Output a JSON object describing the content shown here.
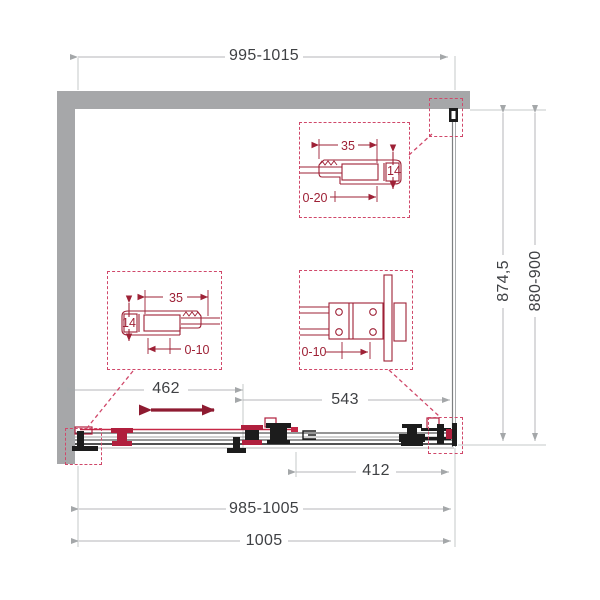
{
  "dimensions": {
    "top_width": "995-1015",
    "side_height_fixed": "874,5",
    "side_height_range": "880-900",
    "door_travel": "462",
    "fixed_panel": "543",
    "opening": "412",
    "bottom_width_range": "985-1005",
    "bottom_width_total": "1005"
  },
  "details": {
    "wall_profile_top": {
      "width": "35",
      "depth": "14",
      "adjustment": "0-20"
    },
    "wall_profile_left": {
      "width": "35",
      "depth": "14",
      "adjustment": "0-10"
    },
    "roller_carriage": {
      "adjustment": "0-10"
    }
  },
  "colors": {
    "wall": "#a6a7a9",
    "dimension_line": "#b4b6b8",
    "dimension_text": "#3f4144",
    "detail_red": "#9e2136",
    "bright_red": "#c62846",
    "dashed_box": "#d0486a",
    "arrow_maroon": "#8e1b31",
    "hardware_black": "#1c1c1c"
  }
}
